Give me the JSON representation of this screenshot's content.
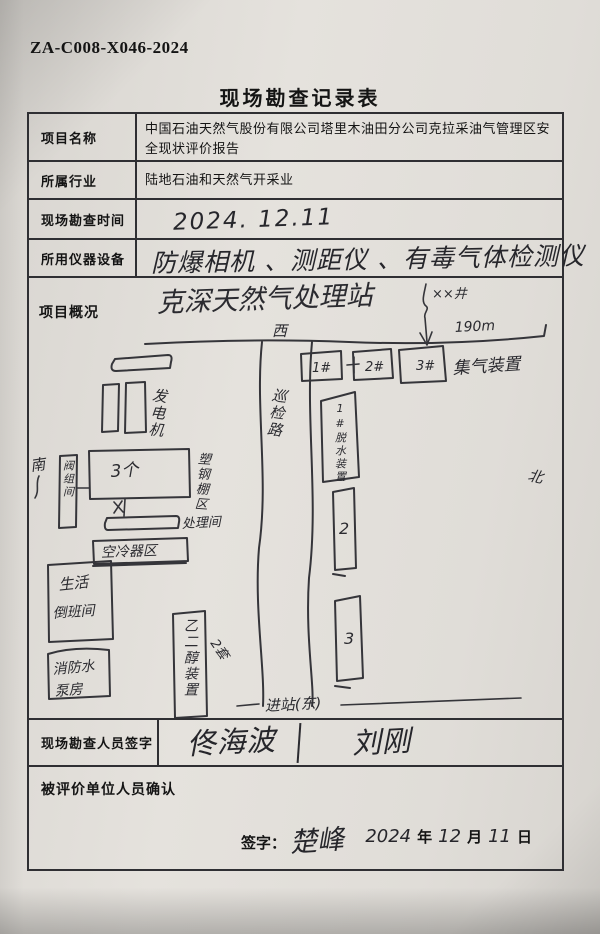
{
  "page": {
    "doc_number": "ZA-C008-X046-2024",
    "title": "现场勘查记录表"
  },
  "form": {
    "rows": [
      {
        "label": "项目名称",
        "value": "中国石油天然气股份有限公司塔里木油田分公司克拉采油气管理区安全现状评价报告"
      },
      {
        "label": "所属行业",
        "value": "陆地石油和天然气开采业"
      },
      {
        "label": "现场勘查时间",
        "value": "2024. 12.11"
      },
      {
        "label": "所用仪器设备",
        "value": "防爆相机 、测距仪 、有毒气体检测仪"
      }
    ],
    "overview_label": "项目概况",
    "surveyor": {
      "label": "现场勘查人员签字",
      "sig1": "佟海波",
      "sig2": "刘刚"
    },
    "confirm": {
      "label": "被评价单位人员确认",
      "sign_label": "签字：",
      "signature": "楚峰",
      "year": "2024",
      "year_unit": "年",
      "month": "12",
      "month_unit": "月",
      "day": "11",
      "day_unit": "日"
    }
  },
  "sketch": {
    "title": "克深天然气处理站",
    "compass_top": "西",
    "compass_left": "南",
    "compass_right": "北",
    "well_label": "××井",
    "distance": "190m",
    "box1": "1#",
    "box2": "2#",
    "box3": "3#",
    "gather_label": "集气装置",
    "generator_label": "发电机",
    "big_building": "3个",
    "shed_label": "塑钢棚区",
    "valve_room": "阀组间",
    "treat_label": "处理间",
    "aircooler_label": "空冷器区",
    "living_line1": "生活",
    "living_line2": "倒班间",
    "fire_line1": "消防水",
    "fire_line2": "泵房",
    "glycol_label": "乙二醇装置",
    "glycol_count": "2套",
    "road_label": "巡检路",
    "dehydrator1": "1#脱水装置",
    "dehydrator2": "2",
    "dehydrator3": "3",
    "entrance_label": "进站(东)"
  }
}
